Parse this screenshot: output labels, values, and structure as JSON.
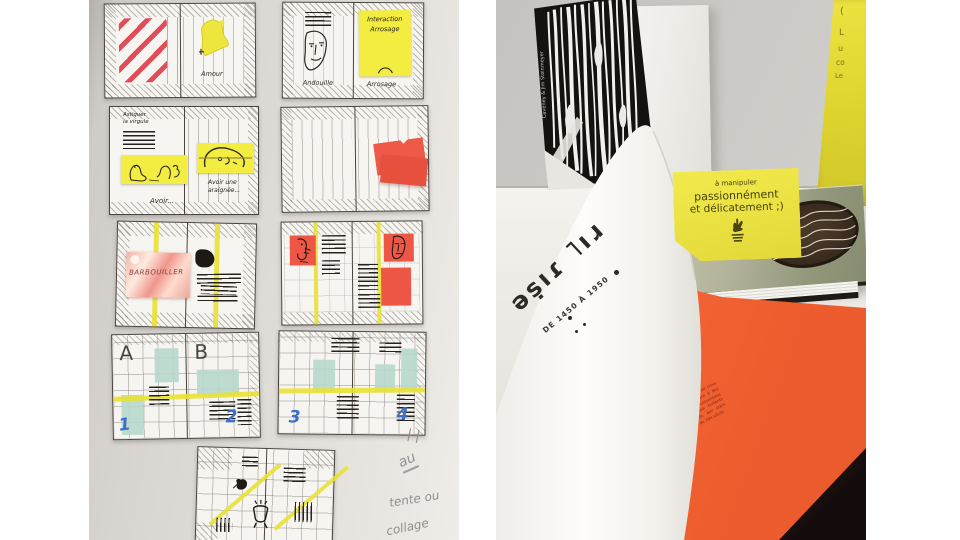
{
  "meta": {
    "description": "Two photographs side by side: hand-drawn book-spread sketches with sticky notes pinned on a wall (left); a table display of optical-illusion books including Les Illusionnistes with an op-art cover and an open book with an orange page (right)"
  },
  "left_photo": {
    "sketch1": {
      "label_right": "Amour"
    },
    "sketch2": {
      "note_line1": "Interaction",
      "note_line2": "Arrosage",
      "label_left": "Andouille",
      "label_right": "Arrosage"
    },
    "sketch3": {
      "title_line1": "Astiquer",
      "title_line2": "la virgule",
      "label_left": "Avoir...",
      "label_right_line1": "Avoir une",
      "label_right_line2": "araignée..."
    },
    "sketch5": {
      "foil_text": "BARBOUILLER"
    },
    "sketch7": {
      "letter_a": "A",
      "letter_b": "B",
      "num_1": "1",
      "num_2": "2"
    },
    "sketch8": {
      "num_3": "3",
      "num_4": "4"
    },
    "pencil_notes": {
      "note_1": "au",
      "note_2": "tente ou",
      "note_3": "collage"
    }
  },
  "right_photo": {
    "opart_book": {
      "spine": "Caveney & Jim Steinmeyer"
    },
    "flyer": {
      "fragment_1": "(",
      "fragment_2": "L",
      "fragment_3": "u",
      "fragment_4": "co",
      "fragment_5": "Le"
    },
    "card": {
      "line_1": "à manipuler",
      "line_2": "passionnément",
      "line_3": "et délicatement ;)"
    },
    "open_book": {
      "title_glyphs": "ǝṣıɾ ˥ıɹ",
      "dates": "DE 1450 À 1950",
      "paragraph": "Véritables pionniers des effets spéciaux, les magiciens ont le don de nous plonger dans la perplexité en rendant l'impossible possible. Grâce à des illustrations sensationnelles et des textes passionnants, Les Illusionnistes explore l'art des magiciens, des mages et escamoteurs aux brillants prestidigitateurs de l'âge d'or de la magie, au XIXe siècle, aux stars internationales comme Houdini et aux autres artistes du début du 20e siècle."
    }
  },
  "colors": {
    "sticky_yellow": "#f3ec41",
    "sticky_red": "#ee5745",
    "highlight_yellow": "#e8e130",
    "teal": "#b9d8cd",
    "orange_page": "#f2642f",
    "flyer_yellow": "#e0d735",
    "number_blue": "#3b6fc9",
    "ink": "#2e2a26"
  }
}
